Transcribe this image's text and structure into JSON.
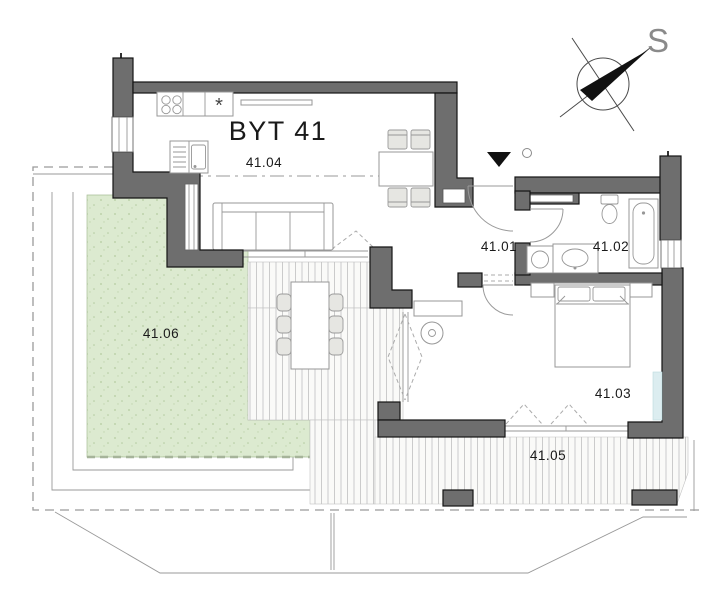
{
  "plan": {
    "title": "BYT 41",
    "compass_letter": "S",
    "sink_symbol": "*",
    "rooms": [
      {
        "id": "41.01",
        "label": "41.01"
      },
      {
        "id": "41.02",
        "label": "41.02"
      },
      {
        "id": "41.03",
        "label": "41.03"
      },
      {
        "id": "41.04",
        "label": "41.04"
      },
      {
        "id": "41.05",
        "label": "41.05"
      },
      {
        "id": "41.06",
        "label": "41.06"
      }
    ],
    "colors": {
      "wall": "#6e6e6e",
      "garden_green": "#dcead0",
      "deck_stripe": "#c6c6c6",
      "radiator_blue": "#dcedf0"
    }
  }
}
